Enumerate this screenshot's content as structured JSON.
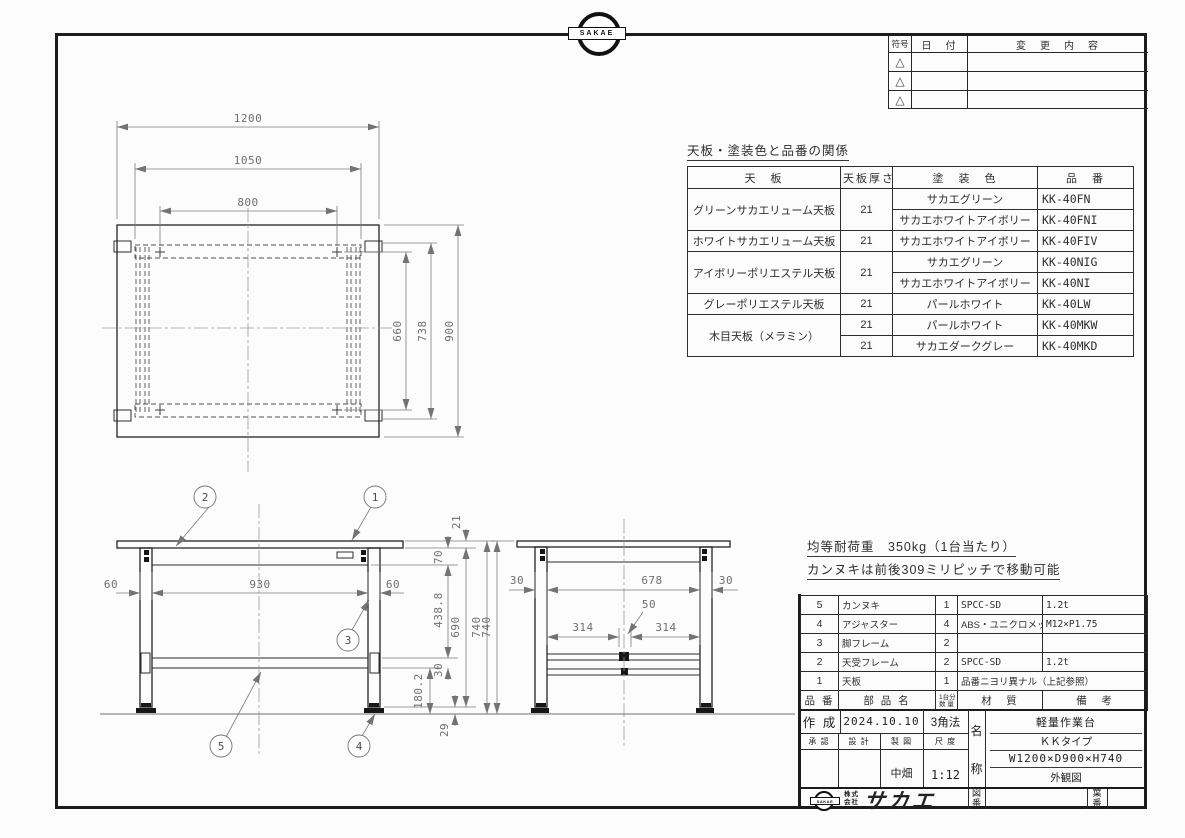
{
  "page": {
    "bg": "#fcfcfc",
    "line_color": "#1c1c1c",
    "dim_color": "#6f6f6f"
  },
  "logo_top": {
    "text": "SAKAE"
  },
  "revision_table": {
    "col_symbol": "符号",
    "col_date": "日　付",
    "col_change": "変　更　内　容",
    "triangle": "△"
  },
  "paint_table": {
    "title": "天板・塗装色と品番の関係",
    "headers": [
      "天　板",
      "天板厚さ",
      "塗　装　色",
      "品　番"
    ],
    "rows": [
      [
        "グリーンサカエリューム天板",
        "21",
        "サカエグリーン",
        "KK-40FN"
      ],
      [
        "",
        "",
        "サカエホワイトアイボリー",
        "KK-40FNI"
      ],
      [
        "ホワイトサカエリューム天板",
        "21",
        "サカエホワイトアイボリー",
        "KK-40FIV"
      ],
      [
        "アイボリーポリエステル天板",
        "21",
        "サカエグリーン",
        "KK-40NIG"
      ],
      [
        "",
        "",
        "サカエホワイトアイボリー",
        "KK-40NI"
      ],
      [
        "グレーポリエステル天板",
        "21",
        "パールホワイト",
        "KK-40LW"
      ],
      [
        "木目天板（メラミン）",
        "21",
        "パールホワイト",
        "KK-40MKW"
      ],
      [
        "",
        "21",
        "サカエダークグレー",
        "KK-40MKD"
      ]
    ]
  },
  "notes": {
    "load": "均等耐荷重　350kg（1台当たり）",
    "move": "カンヌキは前後309ミリピッチで移動可能"
  },
  "parts_table": {
    "header": {
      "no": "品 番",
      "name": "部 品 名",
      "qty1": "1台分",
      "qty2": "数 量",
      "material": "材　質",
      "remarks": "備　考"
    },
    "rows": [
      {
        "no": "5",
        "name": "カンヌキ",
        "qty": "1",
        "material": "SPCC-SD",
        "remarks": "1.2t"
      },
      {
        "no": "4",
        "name": "アジャスター",
        "qty": "4",
        "material": "ABS・ユニクロメッキ",
        "remarks": "M12×P1.75"
      },
      {
        "no": "3",
        "name": "脚フレーム",
        "qty": "2",
        "material": "",
        "remarks": ""
      },
      {
        "no": "2",
        "name": "天受フレーム",
        "qty": "2",
        "material": "SPCC-SD",
        "remarks": "1.2t"
      },
      {
        "no": "1",
        "name": "天板",
        "qty": "1",
        "material": "品番ニヨリ異ナル（上記参照）",
        "remarks": ""
      }
    ]
  },
  "title_block": {
    "created_label": "作 成",
    "created_date": "2024.10.10",
    "projection": "3角法",
    "approved_label": "承 認",
    "design_label": "設 計",
    "draft_label": "製 図",
    "scale_label": "尺 度",
    "drafter": "中畑",
    "scale": "1:12",
    "name_char1": "名",
    "name_char2": "称",
    "name_line1": "軽量作業台",
    "name_line2": "ＫＫタイプ",
    "name_line3": "W1200×D900×H740",
    "name_line4": "外観図",
    "company_line1": "株式",
    "company_line2": "会社",
    "company_name": "サカエ",
    "logo_text": "SAKAE",
    "drawing_no_char1": "図",
    "drawing_no_char2": "番",
    "sheet_no_char1": "葉",
    "sheet_no_char2": "番"
  },
  "top_view": {
    "dim_width": "1200",
    "dim_frame_width": "1050",
    "dim_pitch": "800",
    "dim_inner": "660",
    "dim_frame_depth": "738",
    "dim_depth": "900"
  },
  "front_view": {
    "dim_left_leg": "60",
    "dim_span": "930",
    "dim_right_leg": "60",
    "dim_top_thickness": "21",
    "dim_frame_height": "70",
    "dim_upper": "438.8",
    "dim_bar": "30",
    "dim_lower": "180.2",
    "dim_leg_height": "690",
    "dim_total_height": "740",
    "dim_adjuster": "29",
    "balloon_1": "1",
    "balloon_2": "2",
    "balloon_3": "3",
    "balloon_4": "4",
    "balloon_5": "5"
  },
  "side_view": {
    "dim_left_leg": "30",
    "dim_span": "678",
    "dim_right_leg": "30",
    "dim_bar_width": "50",
    "dim_left_pitch": "314",
    "dim_right_pitch": "314",
    "dim_total_height": "740"
  }
}
